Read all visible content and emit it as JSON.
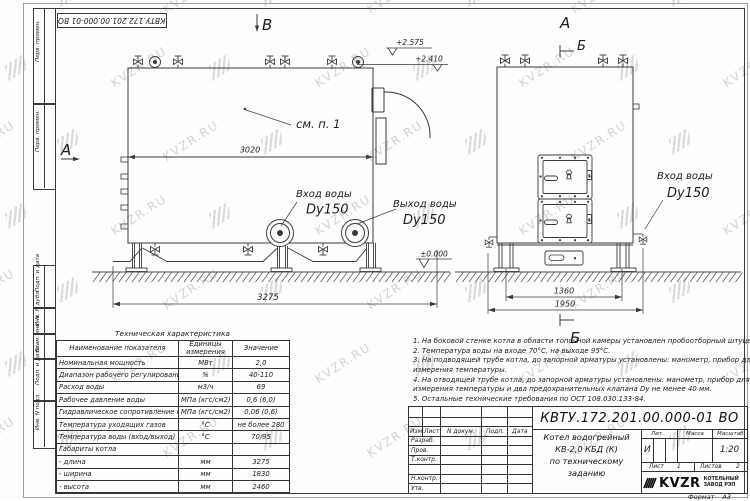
{
  "top_stamp": "КВТУ.172.201.00.000-01 ВО",
  "watermark": {
    "text": "KVZR.RU"
  },
  "margin": {
    "top_cells": [
      "Перв. примен.",
      "Перв. примен."
    ],
    "bottom_cells": [
      "Подп. и дата",
      "Инв. N дубл.",
      "Взам. инв. N",
      "Подп. и дата",
      "Инв. N подл."
    ]
  },
  "views": {
    "front": {
      "label_top": "В",
      "label_left": "А",
      "see_note": "см. п. 1",
      "dim_inner": "3020",
      "dim_length": "3275",
      "elev_top1": "+2.575",
      "elev_top2": "+2.410",
      "elev_ground": "±0.000",
      "inlet_label": "Вход воды",
      "inlet_size": "Dy150",
      "outlet_label": "Выход воды",
      "outlet_size": "Dy150"
    },
    "side": {
      "label_top": "А",
      "section_top": "Б",
      "section_bottom": "Б",
      "dim_base": "1360",
      "dim_overall": "1950",
      "inlet_label": "Вход воды",
      "inlet_size": "Dy150"
    }
  },
  "spec_table": {
    "title": "Техническая характеристика",
    "headers": [
      "Наименование показателя",
      "Единицы измерения",
      "Значение"
    ],
    "rows": [
      [
        "Номинальная мощность",
        "МВт",
        "2,0"
      ],
      [
        "Диапазон рабочего регулирования",
        "%",
        "40-110"
      ],
      [
        "Расход воды",
        "м3/ч",
        "69"
      ],
      [
        "Рабочее давление воды",
        "МПа (кгс/см2)",
        "0,6 (6,0)"
      ],
      [
        "Гидравлическое сопротивление котла",
        "МПа (кгс/см2)",
        "0,06 (0,6)"
      ],
      [
        "Температура уходящих газов",
        "°С",
        "не более 280"
      ],
      [
        "Температура воды (вход/выход)",
        "°С",
        "70/95"
      ],
      [
        "Габариты котла",
        "",
        ""
      ],
      [
        "- длина",
        "мм",
        "3275"
      ],
      [
        "- ширина",
        "мм",
        "1830"
      ],
      [
        "- высота",
        "мм",
        "2460"
      ]
    ]
  },
  "notes": {
    "lines": [
      "1. На боковой стенке котла в области топочной камеры установлен пробоотборный штуцер",
      "2. Температура воды на входе 70°С, на выходе 95°С.",
      "3. На подводящей трубе котла, до запорной арматуры установлены: манометр, прибор для",
      "измерения температуры.",
      "4. На отводящей трубе котла, до запорной арматуры установлены: манометр, прибор для",
      "измерения температуры и два предохранительных клапана Dу не менее 40 мм.",
      "5. Остальные технические требования по ОСТ 108.030.133-84."
    ]
  },
  "title_block": {
    "doc_number": "КВТУ.172.201.00.000-01 ВО",
    "col_headers": [
      "Изм.",
      "Лист",
      "N докум.",
      "Подп.",
      "Дата"
    ],
    "row_labels": [
      "Разраб.",
      "Пров.",
      "Т.контр.",
      "Н.контр.",
      "Утв."
    ],
    "name_lines": [
      "Котел водогрейный",
      "КВ-2,0 КБД (К)",
      "по техническому заданию"
    ],
    "lit_header": "Лит.",
    "mass_header": "Масса",
    "scale_header": "Масштаб",
    "lit_value": "И",
    "scale_value": "1:20",
    "sheet_label": "Лист",
    "sheet_value": "1",
    "sheets_label": "Листов",
    "sheets_value": "2",
    "company": {
      "logo_text": "KVZR",
      "name_line1": "КОТЕЛЬНЫЙ",
      "name_line2": "ЗАВОД РЭП"
    },
    "format_label": "Формат",
    "format_value": "А3"
  }
}
